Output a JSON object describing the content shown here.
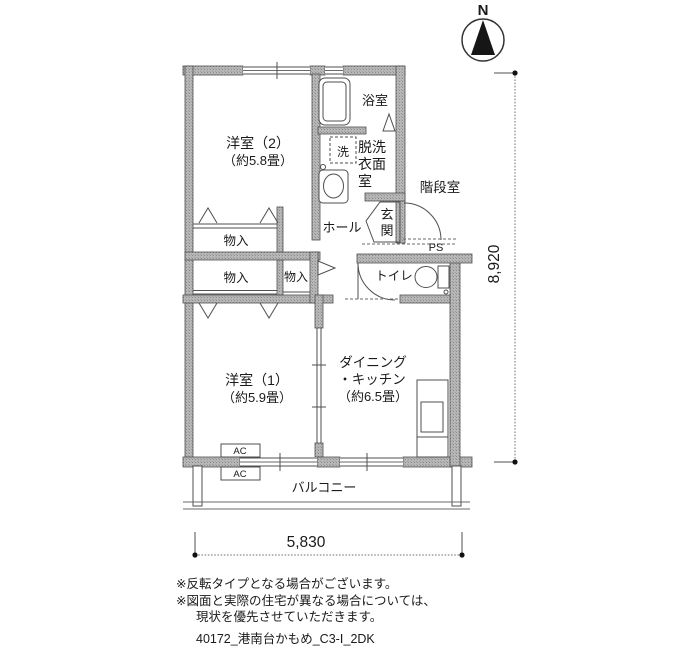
{
  "compass": {
    "label": "N"
  },
  "dimensions": {
    "width_mm": "5,830",
    "height_mm": "8,920"
  },
  "rooms": {
    "bedroom2": {
      "name": "洋室（2）",
      "size": "（約5.8畳）"
    },
    "bedroom1": {
      "name": "洋室（1）",
      "size": "（約5.9畳）"
    },
    "dining_kitchen": {
      "line1": "ダイニング",
      "line2": "・キッチン",
      "line3": "（約6.5畳）"
    },
    "bath": {
      "name": "浴室"
    },
    "washer": {
      "name": "洗"
    },
    "powder_room": {
      "row1": "脱洗",
      "row2": "衣面",
      "row3": "室"
    },
    "stairwell": {
      "name": "階段室"
    },
    "entrance": {
      "char1": "玄",
      "char2": "関"
    },
    "hall": {
      "name": "ホール"
    },
    "pipe_space": {
      "name": "PS"
    },
    "toilet": {
      "name": "トイレ"
    },
    "closet_upper": {
      "name": "物入"
    },
    "closet_lower": {
      "name": "物入"
    },
    "closet_small": {
      "name": "物入"
    },
    "balcony": {
      "name": "バルコニー"
    },
    "ac_unit1": {
      "name": "AC"
    },
    "ac_unit2": {
      "name": "AC"
    }
  },
  "notes": [
    "※反転タイプとなる場合がございます。",
    "※図面と実際の住宅が異なる場合については、",
    "現状を優先させていただきます。"
  ],
  "plan_id": "40172_港南台かもめ_C3-Ⅰ_2DK",
  "colors": {
    "wall_fill": "#b7b7b7",
    "line": "#4f4f4f"
  }
}
